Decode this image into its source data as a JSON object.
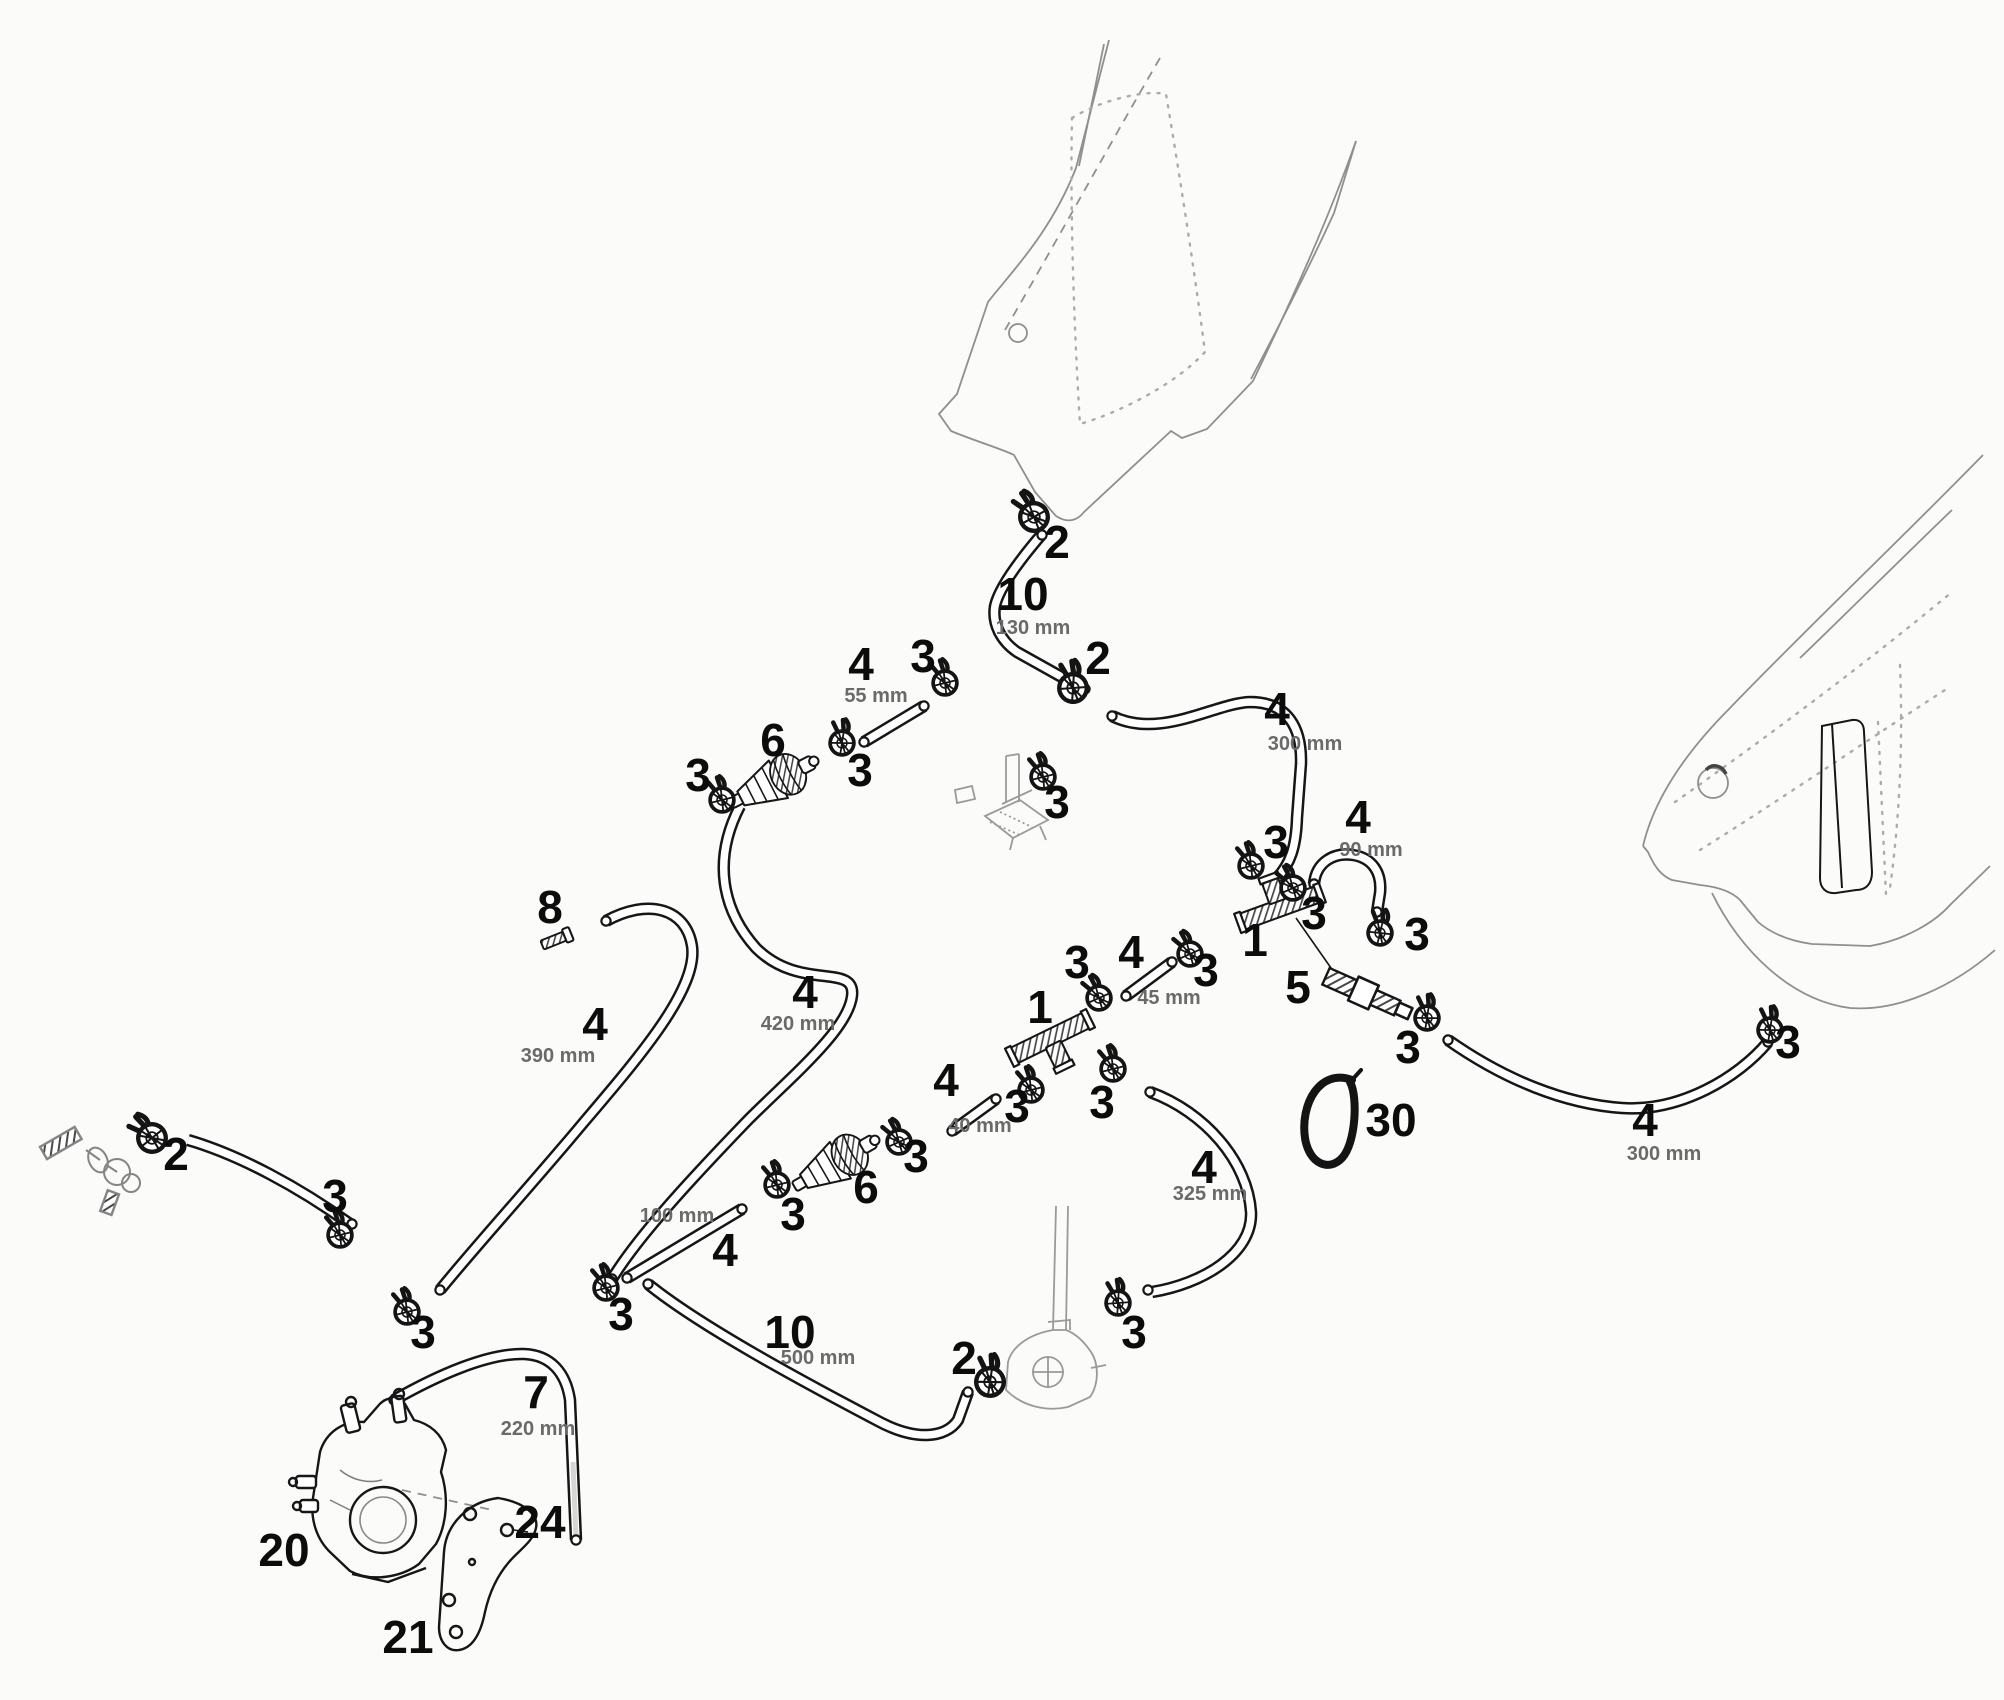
{
  "diagram": {
    "description": "Exploded fuel-line routing parts diagram with numbered callouts and hose lengths",
    "colors": {
      "ink": "#161616",
      "ghost": "#8f8f8f",
      "dim_text": "#6a6a6a",
      "background": "#fbfbf9"
    },
    "callouts": [
      {
        "num": "2",
        "x": 1057,
        "y": 558
      },
      {
        "num": "10",
        "x": 1023,
        "y": 610,
        "dim": "130 mm",
        "dim_x": 1033,
        "dim_y": 634
      },
      {
        "num": "2",
        "x": 1098,
        "y": 674
      },
      {
        "num": "4",
        "x": 861,
        "y": 680,
        "dim": "55 mm",
        "dim_x": 876,
        "dim_y": 702
      },
      {
        "num": "3",
        "x": 923,
        "y": 672
      },
      {
        "num": "6",
        "x": 773,
        "y": 756
      },
      {
        "num": "3",
        "x": 698,
        "y": 791
      },
      {
        "num": "3",
        "x": 860,
        "y": 786
      },
      {
        "num": "4",
        "x": 1277,
        "y": 725,
        "dim": "300 mm",
        "dim_x": 1305,
        "dim_y": 750
      },
      {
        "num": "3",
        "x": 1276,
        "y": 858
      },
      {
        "num": "4",
        "x": 1358,
        "y": 833,
        "dim": "90 mm",
        "dim_x": 1371,
        "dim_y": 856
      },
      {
        "num": "3",
        "x": 1314,
        "y": 929
      },
      {
        "num": "3",
        "x": 1417,
        "y": 950
      },
      {
        "num": "1",
        "x": 1255,
        "y": 956
      },
      {
        "num": "5",
        "x": 1298,
        "y": 1003
      },
      {
        "num": "3",
        "x": 1408,
        "y": 1063
      },
      {
        "num": "3",
        "x": 1788,
        "y": 1058
      },
      {
        "num": "4",
        "x": 1645,
        "y": 1136,
        "dim": "300 mm",
        "dim_x": 1664,
        "dim_y": 1160
      },
      {
        "num": "30",
        "x": 1391,
        "y": 1136
      },
      {
        "num": "8",
        "x": 550,
        "y": 923
      },
      {
        "num": "4",
        "x": 805,
        "y": 1008,
        "dim": "420 mm",
        "dim_x": 798,
        "dim_y": 1030
      },
      {
        "num": "4",
        "x": 595,
        "y": 1040,
        "dim": "390 mm",
        "dim_x": 558,
        "dim_y": 1062
      },
      {
        "num": "2",
        "x": 176,
        "y": 1170
      },
      {
        "num": "3",
        "x": 335,
        "y": 1212
      },
      {
        "num": "3",
        "x": 423,
        "y": 1348
      },
      {
        "num": "4",
        "x": 725,
        "y": 1266,
        "dim": "100 mm",
        "dim_x": 677,
        "dim_y": 1222
      },
      {
        "num": "3",
        "x": 793,
        "y": 1230
      },
      {
        "num": "6",
        "x": 866,
        "y": 1203
      },
      {
        "num": "3",
        "x": 916,
        "y": 1172
      },
      {
        "num": "3",
        "x": 621,
        "y": 1330
      },
      {
        "num": "4",
        "x": 946,
        "y": 1096,
        "dim": "40 mm",
        "dim_x": 980,
        "dim_y": 1132
      },
      {
        "num": "3",
        "x": 1017,
        "y": 1122
      },
      {
        "num": "1",
        "x": 1040,
        "y": 1023
      },
      {
        "num": "3",
        "x": 1077,
        "y": 978
      },
      {
        "num": "4",
        "x": 1131,
        "y": 968,
        "dim": "45 mm",
        "dim_x": 1169,
        "dim_y": 1004
      },
      {
        "num": "3",
        "x": 1206,
        "y": 986
      },
      {
        "num": "3",
        "x": 1102,
        "y": 1118
      },
      {
        "num": "4",
        "x": 1204,
        "y": 1183,
        "dim": "325 mm",
        "dim_x": 1210,
        "dim_y": 1200
      },
      {
        "num": "3",
        "x": 1134,
        "y": 1348
      },
      {
        "num": "2",
        "x": 964,
        "y": 1374
      },
      {
        "num": "10",
        "x": 790,
        "y": 1348,
        "dim": "500 mm",
        "dim_x": 818,
        "dim_y": 1364
      },
      {
        "num": "7",
        "x": 536,
        "y": 1408,
        "dim": "220 mm",
        "dim_x": 538,
        "dim_y": 1435
      },
      {
        "num": "20",
        "x": 284,
        "y": 1566
      },
      {
        "num": "21",
        "x": 408,
        "y": 1653
      },
      {
        "num": "24",
        "x": 540,
        "y": 1538
      },
      {
        "num": "3",
        "x": 1057,
        "y": 818
      }
    ],
    "clamps": [
      {
        "x": 1034,
        "y": 517,
        "rot": -15,
        "type": "2"
      },
      {
        "x": 1073,
        "y": 688,
        "rot": 10,
        "type": "2"
      },
      {
        "x": 990,
        "y": 1382,
        "rot": 15,
        "type": "2"
      },
      {
        "x": 152,
        "y": 1138,
        "rot": -25,
        "type": "2"
      },
      {
        "x": 945,
        "y": 683,
        "rot": 0,
        "type": "3"
      },
      {
        "x": 842,
        "y": 743,
        "rot": 15,
        "type": "3"
      },
      {
        "x": 722,
        "y": 800,
        "rot": 0,
        "type": "3"
      },
      {
        "x": 606,
        "y": 1288,
        "rot": 0,
        "type": "3"
      },
      {
        "x": 777,
        "y": 1185,
        "rot": 0,
        "type": "3"
      },
      {
        "x": 899,
        "y": 1142,
        "rot": -10,
        "type": "3"
      },
      {
        "x": 340,
        "y": 1235,
        "rot": 0,
        "type": "3"
      },
      {
        "x": 407,
        "y": 1312,
        "rot": 0,
        "type": "3"
      },
      {
        "x": 1031,
        "y": 1090,
        "rot": 0,
        "type": "3"
      },
      {
        "x": 1099,
        "y": 998,
        "rot": -10,
        "type": "3"
      },
      {
        "x": 1190,
        "y": 954,
        "rot": -10,
        "type": "3"
      },
      {
        "x": 1113,
        "y": 1069,
        "rot": 0,
        "type": "3"
      },
      {
        "x": 1118,
        "y": 1303,
        "rot": 10,
        "type": "3"
      },
      {
        "x": 1251,
        "y": 866,
        "rot": 0,
        "type": "3"
      },
      {
        "x": 1293,
        "y": 888,
        "rot": -10,
        "type": "3"
      },
      {
        "x": 1380,
        "y": 933,
        "rot": 20,
        "type": "3"
      },
      {
        "x": 1427,
        "y": 1018,
        "rot": 15,
        "type": "3"
      },
      {
        "x": 1770,
        "y": 1030,
        "rot": 15,
        "type": "3"
      },
      {
        "x": 1043,
        "y": 777,
        "rot": 0,
        "type": "3"
      }
    ]
  }
}
